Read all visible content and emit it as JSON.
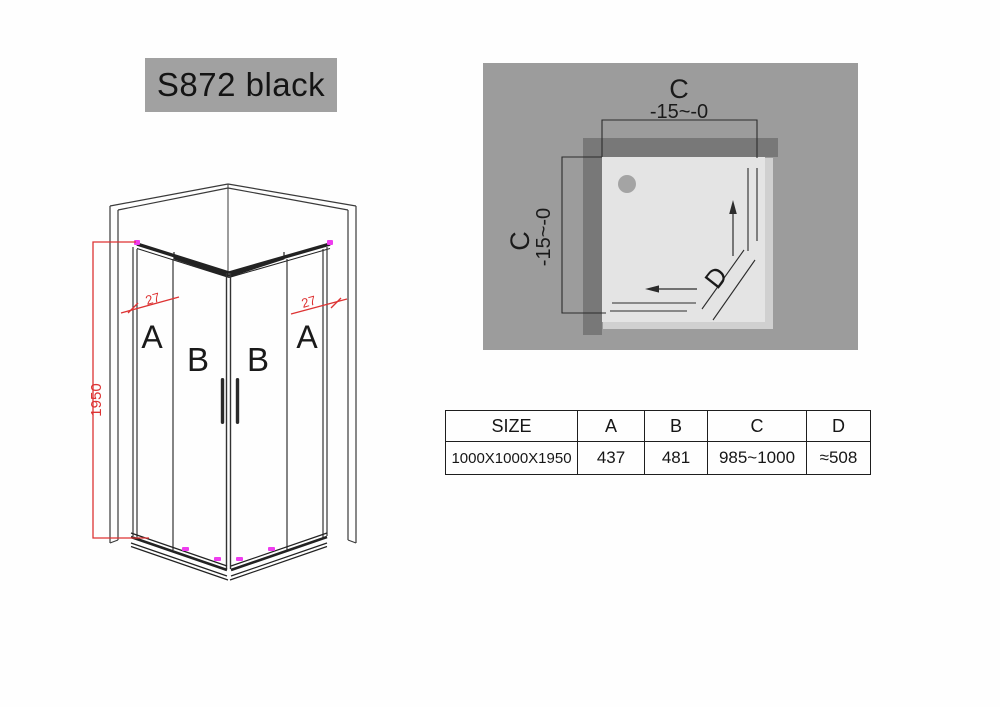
{
  "title": "S872 black",
  "front_view": {
    "panel_labels": [
      "A",
      "B",
      "B",
      "A"
    ],
    "height_dim": "1950",
    "frame_dim_left": "27",
    "frame_dim_right": "27"
  },
  "plan_view": {
    "width_label": "C",
    "width_tolerance": "-15~-0",
    "depth_label": "C",
    "depth_tolerance": "-15~-0",
    "entry_label": "D"
  },
  "spec_table": {
    "headers": [
      "SIZE",
      "A",
      "B",
      "C",
      "D"
    ],
    "rows": [
      [
        "1000X1000X1950",
        "437",
        "481",
        "985~1000",
        "≈508"
      ]
    ]
  },
  "colors": {
    "dimension_red": "#dd3333",
    "marker_magenta": "#ee3cee",
    "plan_background": "#9c9c9c",
    "plan_wall": "#787878",
    "plan_tray": "#e4e4e4",
    "plan_tray_edge": "#d0d0d0",
    "title_background": "#a1a1a1",
    "line_black": "#2a2a2a"
  }
}
